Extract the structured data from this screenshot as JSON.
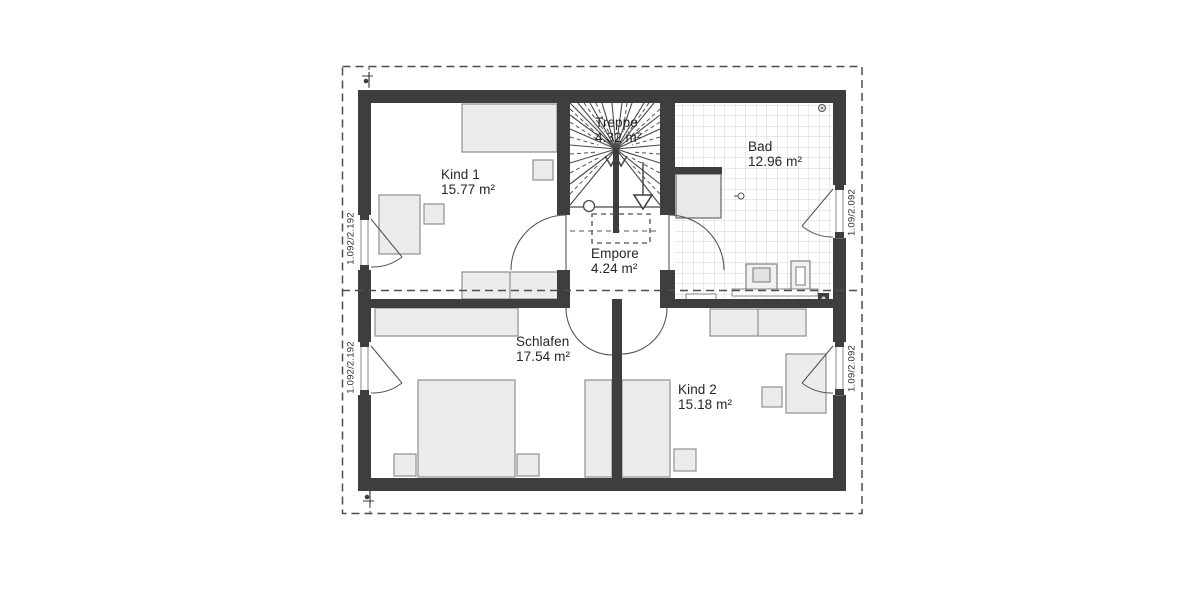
{
  "plan": {
    "type": "architectural-floor-plan-upper-storey",
    "rooms": [
      {
        "name": "Kind 1",
        "area": "15.77 m²"
      },
      {
        "name": "Treppe",
        "area": "4.32 m²"
      },
      {
        "name": "Bad",
        "area": "12.96 m²"
      },
      {
        "name": "Empore",
        "area": "4.24 m²"
      },
      {
        "name": "Schlafen",
        "area": "17.54 m²"
      },
      {
        "name": "Kind 2",
        "area": "15.18 m²"
      }
    ],
    "window_labels": {
      "left": "1.092/2.192",
      "right": "1.09/2.092"
    },
    "colors": {
      "wall": "#3e3e3e",
      "furniture_fill": "#ececec",
      "furniture_border": "#8f8f8f",
      "tile_line": "#c8c8c8",
      "dash_line": "#4d4d4d",
      "text": "#262626",
      "background": "#ffffff"
    }
  }
}
